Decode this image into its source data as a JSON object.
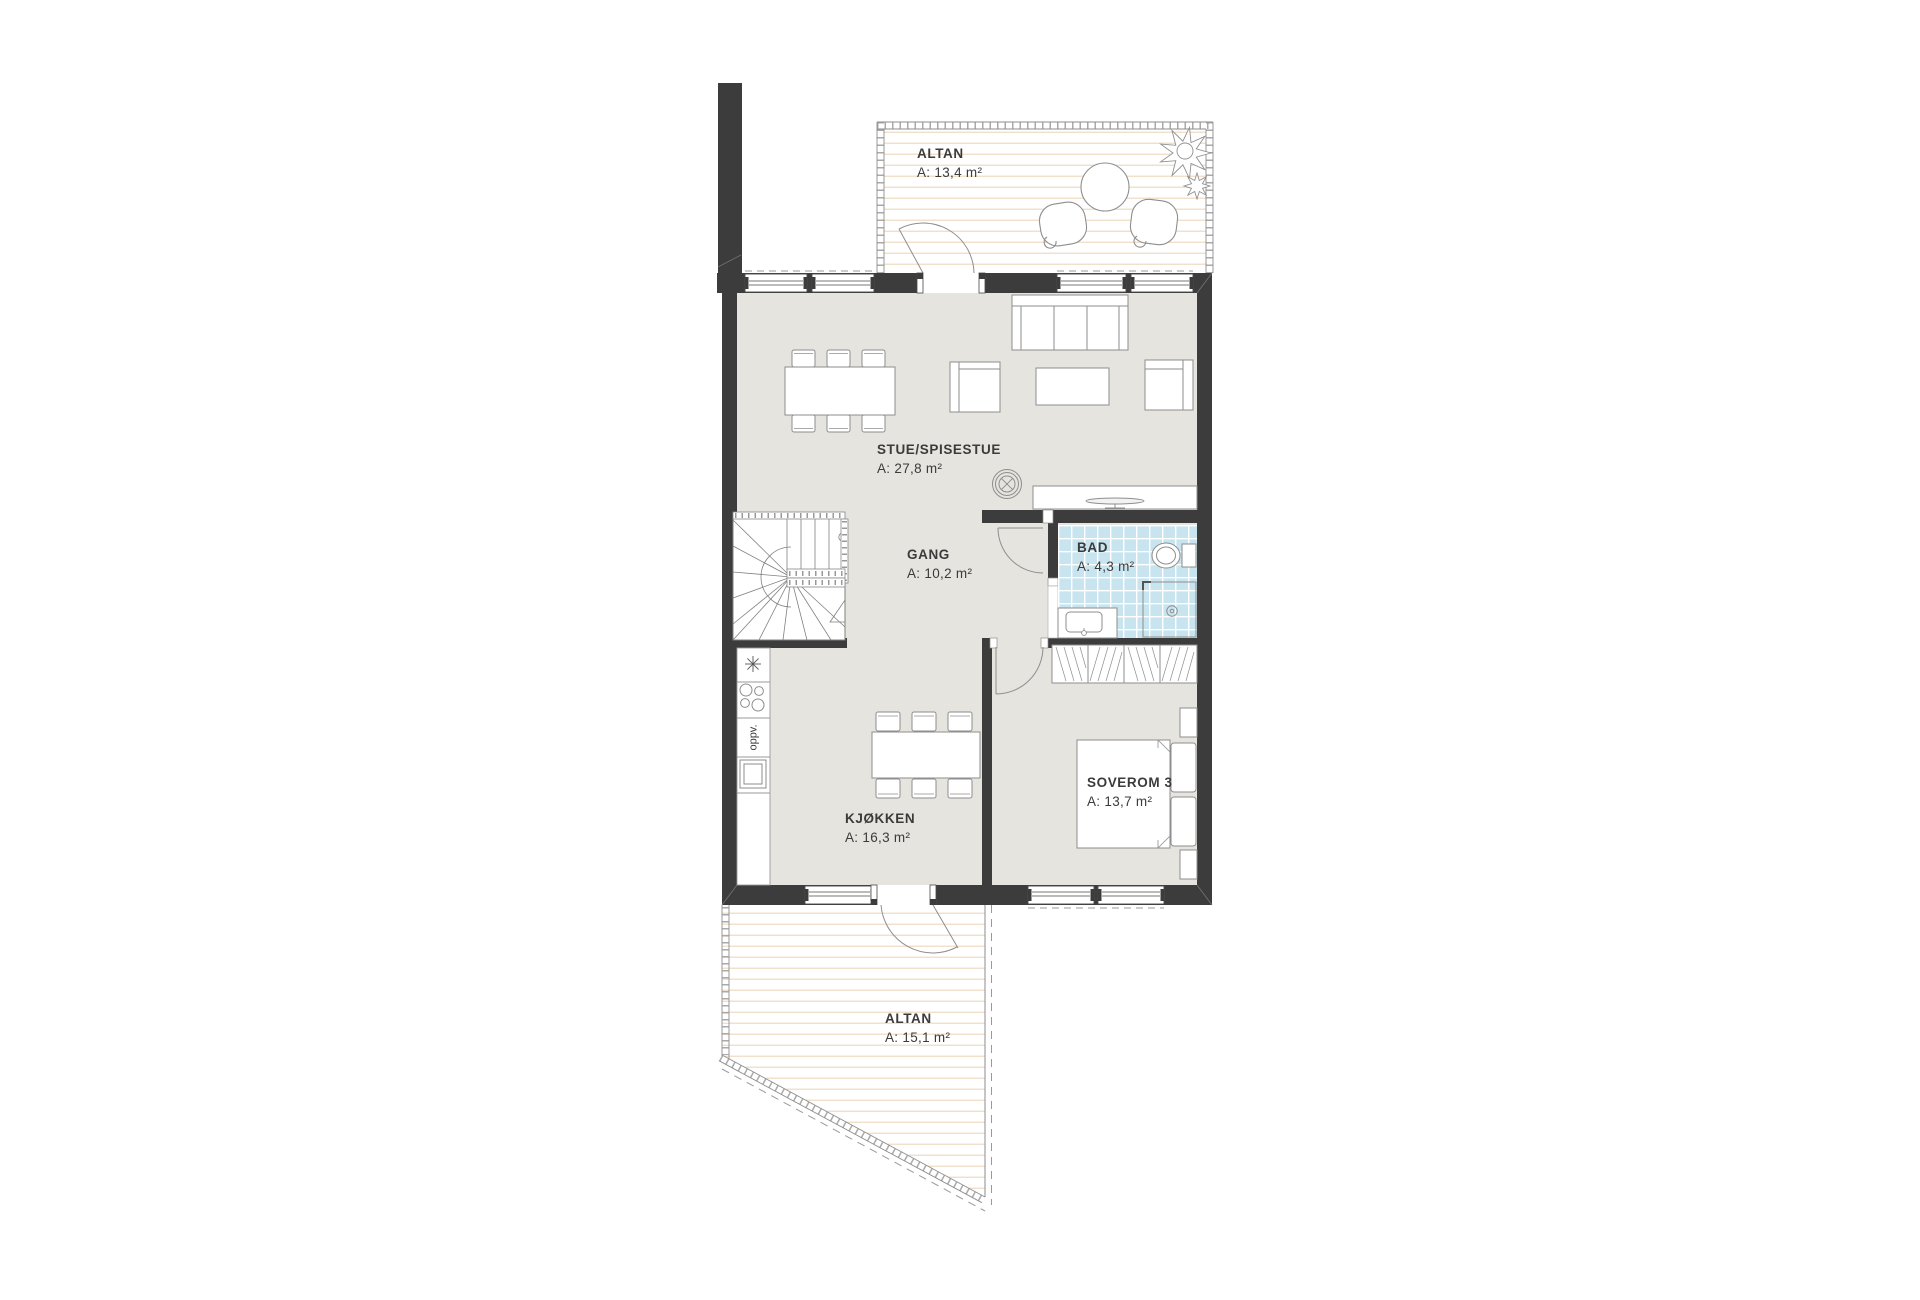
{
  "document": {
    "type": "floor-plan",
    "floor": "plan with two balconies"
  },
  "colors": {
    "wall": "#3c3c3c",
    "floor": "#e5e4df",
    "bath_tile": "#c7e4ef",
    "deck_line": "#f0ddc6",
    "furniture_outline": "#8e8e8e",
    "text": "#3b3b3b"
  },
  "rooms": {
    "altan_top": {
      "name": "ALTAN",
      "area": "A: 13,4 m²"
    },
    "stue": {
      "name": "STUE/SPISESTUE",
      "area": "A: 27,8 m²"
    },
    "gang": {
      "name": "GANG",
      "area": "A: 10,2 m²"
    },
    "bad": {
      "name": "BAD",
      "area": "A: 4,3 m²"
    },
    "kjokken": {
      "name": "KJØKKEN",
      "area": "A: 16,3 m²"
    },
    "soverom_3": {
      "name": "SOVEROM 3",
      "area": "A: 13,7 m²"
    },
    "altan_bottom": {
      "name": "ALTAN",
      "area": "A: 15,1 m²"
    }
  },
  "labels": {
    "dishwasher": "oppv."
  }
}
